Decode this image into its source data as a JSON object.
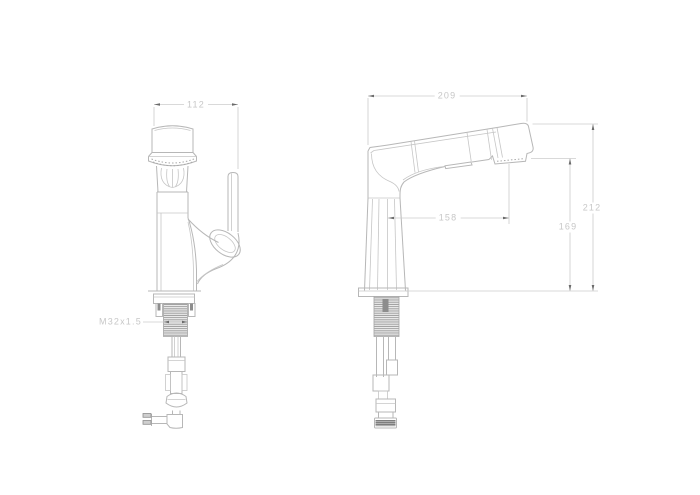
{
  "drawing": {
    "colors": {
      "background": "#ffffff",
      "outline": "#b7b7b7",
      "dimension_line": "#cccccc",
      "dimension_text": "#c7c7c7",
      "thread_hatch": "#9c9c9c",
      "dark_detail": "#8d8d8d"
    },
    "front_view": {
      "dims": {
        "width": "112",
        "thread": "M32x1.5"
      }
    },
    "side_view": {
      "dims": {
        "length": "209",
        "reach": "158",
        "outlet_height": "169",
        "overall_height": "212"
      }
    }
  }
}
